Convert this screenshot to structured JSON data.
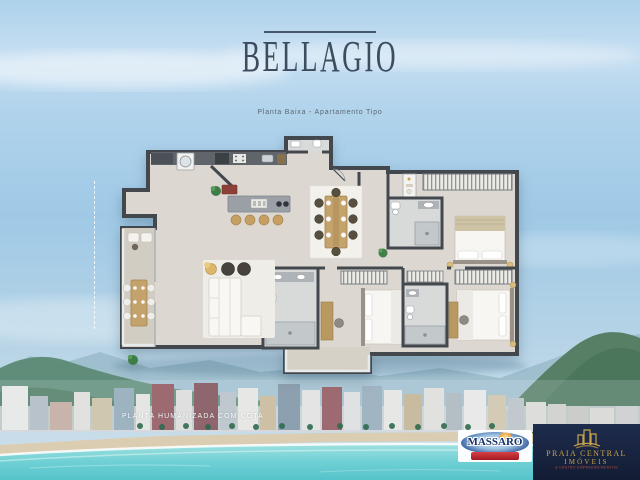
{
  "header": {
    "title": "BELLAGIO",
    "subtitle": "Planta Baixa - Apartamento Tipo"
  },
  "floor_plan": {
    "caption": "PLANTA HUMANIZADA COM COTA"
  },
  "logos": {
    "massaro": {
      "name": "MASSARO",
      "tagline": "construtora"
    },
    "praia_central": {
      "name_line1": "PRAIA CENTRAL",
      "name_line2": "IMÓVEIS",
      "subline": "& CASTRO EMPREENDIMENTOS"
    }
  },
  "colors": {
    "title_text": "#3d4d60",
    "plan_walls": "#43484e",
    "plan_floor": "#dcd8d1",
    "massaro_navy": "#1b3a74",
    "massaro_red": "#b7242b",
    "praia_navy": "#18223d",
    "praia_gold": "#c9a24a",
    "sea": "#6fd0d4"
  }
}
